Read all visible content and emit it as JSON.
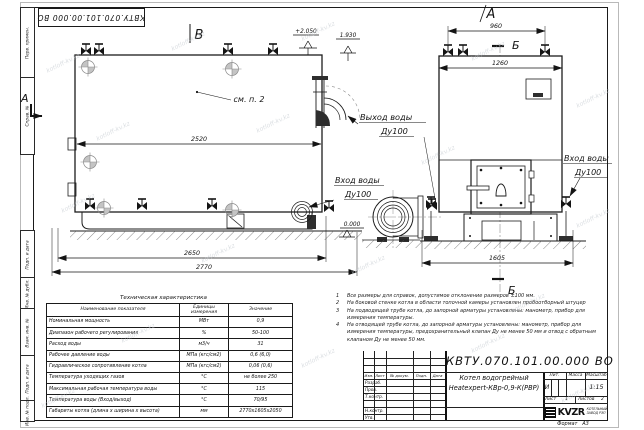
{
  "watermark": "kotloff-kv.kz",
  "margin": {
    "top_cells": [
      "Перв. примен.",
      "Справ. №"
    ],
    "bottom_cells": [
      "Подп. и дата",
      "Инв. № дубл.",
      "Взам. инв. №",
      "Подп. и дата",
      "Инв. № подл."
    ]
  },
  "drawing": {
    "section_marks": {
      "v": "В",
      "a_top": "А",
      "b_top": "Б",
      "b_bottom": "Б",
      "a_left": "А"
    },
    "annotations": {
      "see_item": "см. п. 2",
      "elev_top": "+2.050",
      "elev_mid": "1.930",
      "elev_zero": "0.000",
      "outlet_line1": "Выход воды",
      "outlet_line2": "Ду100",
      "inlet_left_line1": "Вход воды",
      "inlet_left_line2": "Ду100",
      "inlet_right_line1": "Вход воды",
      "inlet_right_line2": "Ду100"
    },
    "dimensions": {
      "side_top": "2520",
      "side_mid": "2650",
      "side_bottom": "2770",
      "front_top": "960",
      "front_width": "1260",
      "front_bottom": "1605"
    }
  },
  "notes": {
    "items": [
      {
        "num": "1",
        "text": "Все размеры для справок, допустимое отклонение размеров ±100 мм."
      },
      {
        "num": "2",
        "text": "На боковой стенке котла в области топочной камеры установлен пробоотборный штуцер"
      },
      {
        "num": "3",
        "text": "На подводящей трубе котла, до запорной арматуры установлены: манометр, прибор для измерения температуры."
      },
      {
        "num": "4",
        "text": "На отводящей трубе котла, до запорной арматуры установлены: манометр, прибор для измерения температуры, предохранительный клапан Ду не менее 50 мм и отвод с обратным клапаном Ду не менее 50 мм."
      }
    ]
  },
  "spec_table": {
    "title": "Техническая характеристика",
    "headers": [
      "Наименование показателя",
      "Единицы измерения",
      "Значение"
    ],
    "rows": [
      [
        "Номинальная мощность",
        "МВт",
        "0,9"
      ],
      [
        "Диапазон рабочего регулирования",
        "%",
        "50-100"
      ],
      [
        "Расход воды",
        "м3/ч",
        "31"
      ],
      [
        "Рабочее давление воды",
        "МПа (кгс/см2)",
        "0,6 (6,0)"
      ],
      [
        "Гидравлическое сопротивление котла",
        "МПа (кгс/см2)",
        "0,06 (0,6)"
      ],
      [
        "Температура уходящих газов",
        "°С",
        "не более 250"
      ],
      [
        "Максимальная рабочая температура воды",
        "°С",
        "115"
      ],
      [
        "Температура воды (Вход/выход)",
        "°С",
        "70/95"
      ],
      [
        "Габариты котла (длина х ширина х высота)",
        "мм",
        "2770х1605х2050"
      ]
    ]
  },
  "title_block": {
    "doc_number": "КВТУ.070.101.00.000  ВО",
    "product_name_line1": "Котел водогрейный",
    "product_name_line2": "Heatexpert-КВр-0,9-К(РВР)",
    "sign_headers": [
      "Изм.",
      "Лист",
      "№ докум.",
      "Подп.",
      "Дата"
    ],
    "sign_rows": [
      "Разраб.",
      "Пров.",
      "Т.контр.",
      "Н.контр.",
      "Утв."
    ],
    "lit_header": "Лит.",
    "mass_header": "Масса",
    "scale_header": "Масштаб",
    "lit_value": "И",
    "scale_value": "1:15",
    "sheet_label": "Лист",
    "sheet_value": "1",
    "sheets_label": "Листов",
    "sheets_value": "2",
    "logo_text": "KVZR",
    "company_line1": "КОТЕЛЬНЫЙ",
    "company_line2": "ЗАВОД РЭП",
    "format_label": "Формат",
    "format_value": "А3"
  }
}
